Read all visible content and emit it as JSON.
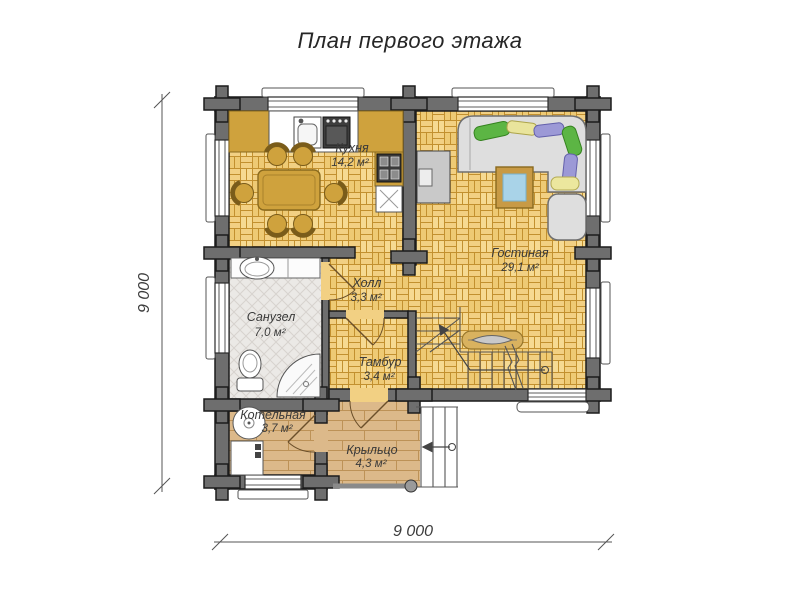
{
  "title": "План первого этажа",
  "rooms": [
    {
      "name": "Кухня",
      "area": "14,2 м²"
    },
    {
      "name": "Гостиная",
      "area": "29,1 м²"
    },
    {
      "name": "Холл",
      "area": "3,3 м²"
    },
    {
      "name": "Санузел",
      "area": "7,0 м²"
    },
    {
      "name": "Тамбур",
      "area": "3,4 м²"
    },
    {
      "name": "Котельная",
      "area": "3,7 м²"
    },
    {
      "name": "Крыльцо",
      "area": "4,3 м²"
    }
  ],
  "dimensions": {
    "vertical": "9 000",
    "horizontal": "9 000"
  },
  "colors": {
    "wall": "#6e6e6e",
    "parquet": "#f2d083",
    "bath_tile": "#ebe9e6",
    "wood_plank": "#dcb98a",
    "counter": "#cfa23d",
    "sofa": "#dedede",
    "pillow_green": "#5cb544",
    "pillow_yellow": "#ece79e",
    "pillow_purple": "#9c99d6",
    "coffee_table_glass": "#a9d3e8"
  }
}
